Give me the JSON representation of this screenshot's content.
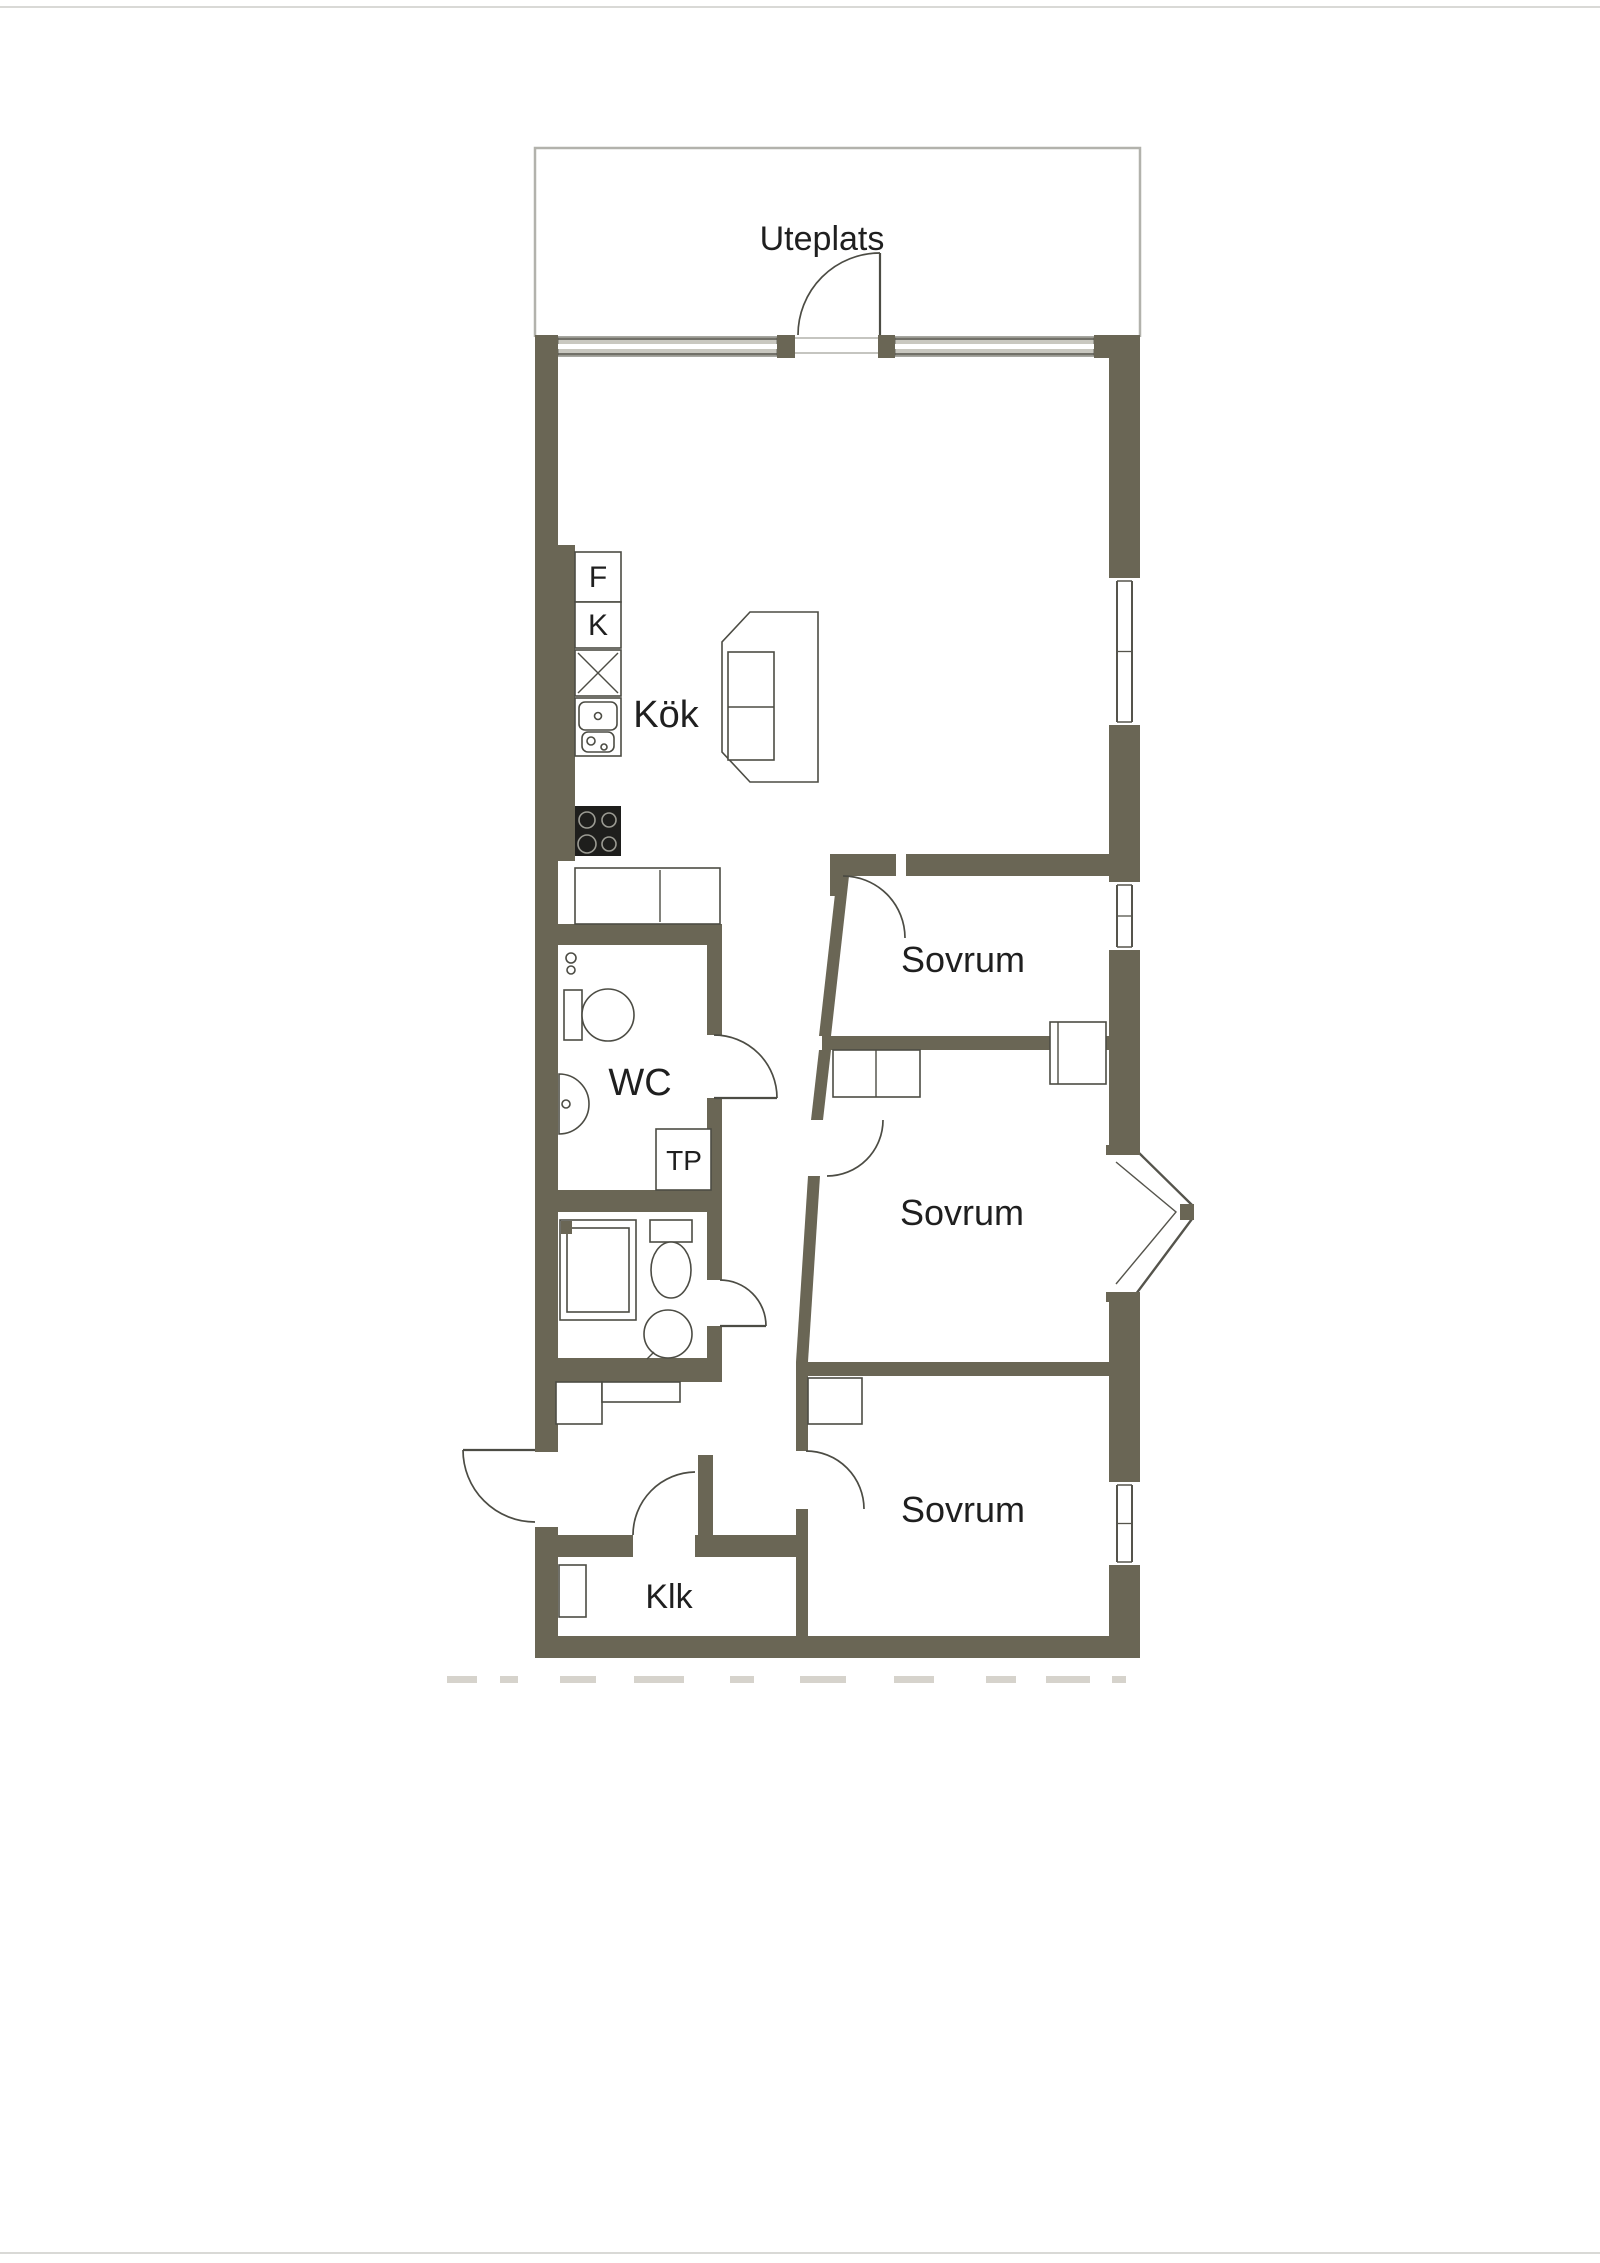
{
  "page": {
    "width": 1600,
    "height": 2263,
    "background": "#ffffff",
    "top_rule_y": 6,
    "bottom_rule_y": 2252,
    "rule_color": "#d9d9d6"
  },
  "floorplan": {
    "colors": {
      "wall": "#6a6655",
      "line": "#4c4c44",
      "thin": "#55544c",
      "patio_border": "#b2b2ac",
      "glazing_fill": "#c9c8c0",
      "glazing_edge": "#8a8a82",
      "burner": "#9b9b93",
      "stove_fill": "#1e1e1c",
      "faint": "#d6d3cc",
      "text": "#1f1f1f"
    },
    "patio": {
      "outline": "M535,337 L535,148 L1140,148 L1140,337"
    },
    "top_window_band": {
      "y": 337,
      "h": 19,
      "segments": [
        {
          "x1": 558,
          "x2": 777
        },
        {
          "x1": 895,
          "x2": 1094
        }
      ]
    },
    "patio_threshold": {
      "x1": 795,
      "x2": 878,
      "y1": 338,
      "y2": 353
    },
    "right_wall": {
      "x": 1109,
      "w": 31
    },
    "right_windows": [
      {
        "name": "window-living-room",
        "y1": 578,
        "y2": 725
      },
      {
        "name": "window-sovrum-1",
        "y1": 882,
        "y2": 950
      },
      {
        "name": "window-sovrum-3",
        "y1": 1482,
        "y2": 1565
      }
    ],
    "bay_window": {
      "fill_poly": "1106,1155 1190,1212 1106,1292",
      "outer_line": "1136,1150 1192,1205 1192,1219 1136,1294",
      "inner_line": "1116,1162 1176,1212 1116,1284",
      "apex_block": {
        "x": 1180,
        "y": 1204,
        "w": 14,
        "h": 16
      },
      "wedges": [
        {
          "x": 1106,
          "y": 1145,
          "w": 34,
          "h": 10
        },
        {
          "x": 1106,
          "y": 1292,
          "w": 34,
          "h": 10
        }
      ]
    },
    "walls": [
      {
        "x": 535,
        "y": 335,
        "w": 23,
        "h": 1117
      },
      {
        "x": 535,
        "y": 1527,
        "w": 23,
        "h": 131
      },
      {
        "x": 535,
        "y": 335,
        "w": 23,
        "h": 23
      },
      {
        "x": 777,
        "y": 335,
        "w": 18,
        "h": 23
      },
      {
        "x": 878,
        "y": 335,
        "w": 17,
        "h": 23
      },
      {
        "x": 1094,
        "y": 335,
        "w": 46,
        "h": 23
      },
      {
        "x": 1109,
        "y": 335,
        "w": 31,
        "h": 243
      },
      {
        "x": 1109,
        "y": 725,
        "w": 31,
        "h": 157
      },
      {
        "x": 1109,
        "y": 950,
        "w": 31,
        "h": 205
      },
      {
        "x": 1109,
        "y": 1292,
        "w": 31,
        "h": 190
      },
      {
        "x": 1109,
        "y": 1565,
        "w": 31,
        "h": 93
      },
      {
        "x": 535,
        "y": 1636,
        "w": 605,
        "h": 22
      },
      {
        "x": 557,
        "y": 545,
        "w": 18,
        "h": 316
      },
      {
        "x": 557,
        "y": 924,
        "w": 165,
        "h": 21
      },
      {
        "x": 707,
        "y": 945,
        "w": 15,
        "h": 90
      },
      {
        "x": 707,
        "y": 1098,
        "w": 15,
        "h": 114
      },
      {
        "x": 557,
        "y": 1190,
        "w": 165,
        "h": 22
      },
      {
        "x": 707,
        "y": 1212,
        "w": 15,
        "h": 68
      },
      {
        "x": 707,
        "y": 1326,
        "w": 15,
        "h": 56
      },
      {
        "x": 557,
        "y": 1358,
        "w": 165,
        "h": 24
      },
      {
        "x": 553,
        "y": 1535,
        "w": 80,
        "h": 22
      },
      {
        "x": 695,
        "y": 1535,
        "w": 106,
        "h": 22
      },
      {
        "x": 698,
        "y": 1455,
        "w": 15,
        "h": 80
      },
      {
        "x": 796,
        "y": 1362,
        "w": 12,
        "h": 89
      },
      {
        "x": 796,
        "y": 1509,
        "w": 12,
        "h": 127
      },
      {
        "x": 830,
        "y": 854,
        "w": 66,
        "h": 22
      },
      {
        "x": 906,
        "y": 854,
        "w": 203,
        "h": 22
      },
      {
        "x": 830,
        "y": 854,
        "w": 13,
        "h": 42
      },
      {
        "x": 822,
        "y": 1036,
        "w": 287,
        "h": 14
      },
      {
        "x": 800,
        "y": 1362,
        "w": 309,
        "h": 14
      }
    ],
    "wall_polys": [
      {
        "name": "wall-sovrum1-west",
        "pts": "837,876 849,876 831,1036 819,1036"
      },
      {
        "name": "wall-sovrum2-west-upper",
        "pts": "819,1050 831,1050 823,1120 811,1120"
      },
      {
        "name": "wall-sovrum2-west-lower",
        "pts": "808,1176 820,1176 808,1362 796,1362"
      }
    ],
    "doors": [
      {
        "name": "patio-door",
        "arc": "M880,253 A82,82 0 0 0 798,335",
        "leaf": "M880,253 L880,335"
      },
      {
        "name": "sovrum1-door",
        "arc": "M843,876 A62,62 0 0 1 905,938"
      },
      {
        "name": "sovrum2-door",
        "arc": "M883,1120 A56,56 0 0 1 827,1176"
      },
      {
        "name": "sovrum3-door",
        "arc": "M806,1451 A58,58 0 0 1 864,1509"
      },
      {
        "name": "wc-door",
        "arc": "M714,1035 A63,63 0 0 1 777,1098",
        "leaf": "M714,1098 L777,1098"
      },
      {
        "name": "bath-door",
        "arc": "M720,1280 A46,46 0 0 1 766,1326",
        "leaf": "M720,1326 L766,1326"
      },
      {
        "name": "klk-door",
        "arc": "M695,1472 A63,63 0 0 0 633,1535"
      },
      {
        "name": "entry-door",
        "arc": "M463,1450 A72,72 0 0 0 535,1522",
        "leaf": "M463,1450 L535,1450"
      }
    ],
    "fixtures": [
      {
        "n": "fridge-box",
        "t": "rect",
        "x": 575,
        "y": 552,
        "w": 46,
        "h": 50
      },
      {
        "n": "freezer-box",
        "t": "rect",
        "x": 575,
        "y": 602,
        "w": 46,
        "h": 46
      },
      {
        "n": "dishwasher-box",
        "t": "rect",
        "x": 575,
        "y": 650,
        "w": 46,
        "h": 46
      },
      {
        "n": "dishwasher-cross-1",
        "t": "line",
        "x1": 578,
        "y1": 653,
        "x2": 618,
        "y2": 693
      },
      {
        "n": "dishwasher-cross-2",
        "t": "line",
        "x1": 618,
        "y1": 653,
        "x2": 578,
        "y2": 693
      },
      {
        "n": "sink-unit",
        "t": "rect",
        "x": 575,
        "y": 698,
        "w": 46,
        "h": 58
      },
      {
        "n": "sink-basin",
        "t": "rect",
        "x": 579,
        "y": 702,
        "w": 38,
        "h": 28,
        "rx": 6
      },
      {
        "n": "sink-drain",
        "t": "circle",
        "cx": 598,
        "cy": 716,
        "r": 3.5
      },
      {
        "n": "sink-basin-small",
        "t": "rect",
        "x": 582,
        "y": 732,
        "w": 32,
        "h": 20,
        "rx": 6
      },
      {
        "n": "sink-drain-small",
        "t": "circle",
        "cx": 591,
        "cy": 741,
        "r": 4
      },
      {
        "n": "sink-tap-dot",
        "t": "circle",
        "cx": 604,
        "cy": 747,
        "r": 3
      },
      {
        "n": "stove",
        "t": "rect",
        "x": 575,
        "y": 806,
        "w": 46,
        "h": 50,
        "f": "#1e1e1c",
        "s": "none"
      },
      {
        "n": "burner-1",
        "t": "circle",
        "cx": 587,
        "cy": 820,
        "r": 8,
        "s": "#9b9b93"
      },
      {
        "n": "burner-2",
        "t": "circle",
        "cx": 609,
        "cy": 820,
        "r": 7,
        "s": "#9b9b93"
      },
      {
        "n": "burner-3",
        "t": "circle",
        "cx": 587,
        "cy": 844,
        "r": 9,
        "s": "#9b9b93"
      },
      {
        "n": "burner-4",
        "t": "circle",
        "cx": 609,
        "cy": 844,
        "r": 7,
        "s": "#9b9b93"
      },
      {
        "n": "kitchen-counter",
        "t": "rect",
        "x": 575,
        "y": 868,
        "w": 145,
        "h": 56
      },
      {
        "n": "kitchen-counter-divider",
        "t": "line",
        "x1": 660,
        "y1": 870,
        "x2": 660,
        "y2": 922
      },
      {
        "n": "kitchen-island",
        "t": "poly",
        "pts": "750,612 818,612 818,782 750,782 722,752 722,642"
      },
      {
        "n": "kitchen-island-inner",
        "t": "rect",
        "x": 728,
        "y": 652,
        "w": 46,
        "h": 108
      },
      {
        "n": "kitchen-island-line",
        "t": "line",
        "x1": 728,
        "y1": 707,
        "x2": 774,
        "y2": 707
      },
      {
        "n": "wc-toilet-tank",
        "t": "rect",
        "x": 564,
        "y": 990,
        "w": 18,
        "h": 50
      },
      {
        "n": "wc-toilet-bowl",
        "t": "ellipse",
        "cx": 608,
        "cy": 1015,
        "rx": 26,
        "ry": 26
      },
      {
        "n": "wc-basin",
        "t": "path",
        "d": "M559,1074 A30,30 0 0 1 559,1134 Z"
      },
      {
        "n": "wc-basin-drain",
        "t": "circle",
        "cx": 566,
        "cy": 1104,
        "r": 4
      },
      {
        "n": "floor-drain-1",
        "t": "circle",
        "cx": 571,
        "cy": 958,
        "r": 5
      },
      {
        "n": "floor-drain-2",
        "t": "circle",
        "cx": 571,
        "cy": 970,
        "r": 4
      },
      {
        "n": "tp-cabinet",
        "t": "rect",
        "x": 656,
        "y": 1129,
        "w": 55,
        "h": 61
      },
      {
        "n": "shower-outer",
        "t": "rect",
        "x": 560,
        "y": 1220,
        "w": 76,
        "h": 100
      },
      {
        "n": "shower-inner",
        "t": "rect",
        "x": 567,
        "y": 1228,
        "w": 62,
        "h": 84
      },
      {
        "n": "shower-valve",
        "t": "rect",
        "x": 561,
        "y": 1221,
        "w": 11,
        "h": 13,
        "f": "#6a6655",
        "s": "none"
      },
      {
        "n": "bath-toilet-tank",
        "t": "rect",
        "x": 650,
        "y": 1220,
        "w": 42,
        "h": 22
      },
      {
        "n": "bath-toilet-bowl",
        "t": "ellipse",
        "cx": 671,
        "cy": 1270,
        "rx": 20,
        "ry": 28
      },
      {
        "n": "bath-basin",
        "t": "circle",
        "cx": 668,
        "cy": 1334,
        "r": 24
      },
      {
        "n": "bath-basin-tap",
        "t": "line",
        "x1": 654,
        "y1": 1352,
        "x2": 647,
        "y2": 1359
      },
      {
        "n": "hall-closet-1",
        "t": "rect",
        "x": 556,
        "y": 1382,
        "w": 46,
        "h": 42
      },
      {
        "n": "hall-closet-2",
        "t": "rect",
        "x": 602,
        "y": 1382,
        "w": 78,
        "h": 20
      },
      {
        "n": "klk-shelf",
        "t": "rect",
        "x": 559,
        "y": 1565,
        "w": 27,
        "h": 52
      },
      {
        "n": "sovrum1-closet",
        "t": "rect",
        "x": 1050,
        "y": 1022,
        "w": 56,
        "h": 62
      },
      {
        "n": "sovrum1-closet-line",
        "t": "line",
        "x1": 1058,
        "y1": 1022,
        "x2": 1058,
        "y2": 1084
      },
      {
        "n": "sovrum2-closet",
        "t": "rect",
        "x": 833,
        "y": 1050,
        "w": 87,
        "h": 47
      },
      {
        "n": "sovrum2-closet-line",
        "t": "line",
        "x1": 876,
        "y1": 1050,
        "x2": 876,
        "y2": 1097
      },
      {
        "n": "sovrum3-closet",
        "t": "rect",
        "x": 808,
        "y": 1378,
        "w": 54,
        "h": 46
      }
    ],
    "labels": [
      {
        "n": "room-label-uteplats",
        "text": "Uteplats",
        "x": 822,
        "y": 250,
        "fs": 34
      },
      {
        "n": "room-label-kok",
        "text": "Kök",
        "x": 666,
        "y": 727,
        "fs": 38
      },
      {
        "n": "appliance-label-f",
        "text": "F",
        "x": 598,
        "y": 587,
        "fs": 30
      },
      {
        "n": "appliance-label-k",
        "text": "K",
        "x": 598,
        "y": 635,
        "fs": 30
      },
      {
        "n": "room-label-wc",
        "text": "WC",
        "x": 640,
        "y": 1095,
        "fs": 38
      },
      {
        "n": "appliance-label-tp",
        "text": "TP",
        "x": 684,
        "y": 1170,
        "fs": 28
      },
      {
        "n": "room-label-sovrum-1",
        "text": "Sovrum",
        "x": 963,
        "y": 972,
        "fs": 36
      },
      {
        "n": "room-label-sovrum-2",
        "text": "Sovrum",
        "x": 962,
        "y": 1225,
        "fs": 36
      },
      {
        "n": "room-label-sovrum-3",
        "text": "Sovrum",
        "x": 963,
        "y": 1522,
        "fs": 36
      },
      {
        "n": "room-label-klk",
        "text": "Klk",
        "x": 669,
        "y": 1608,
        "fs": 34
      }
    ],
    "faint_marks": {
      "y": 1676,
      "h": 7,
      "segments": [
        [
          447,
          30
        ],
        [
          500,
          18
        ],
        [
          560,
          36
        ],
        [
          634,
          50
        ],
        [
          730,
          24
        ],
        [
          800,
          46
        ],
        [
          894,
          40
        ],
        [
          986,
          30
        ],
        [
          1046,
          44
        ],
        [
          1112,
          14
        ]
      ]
    }
  }
}
